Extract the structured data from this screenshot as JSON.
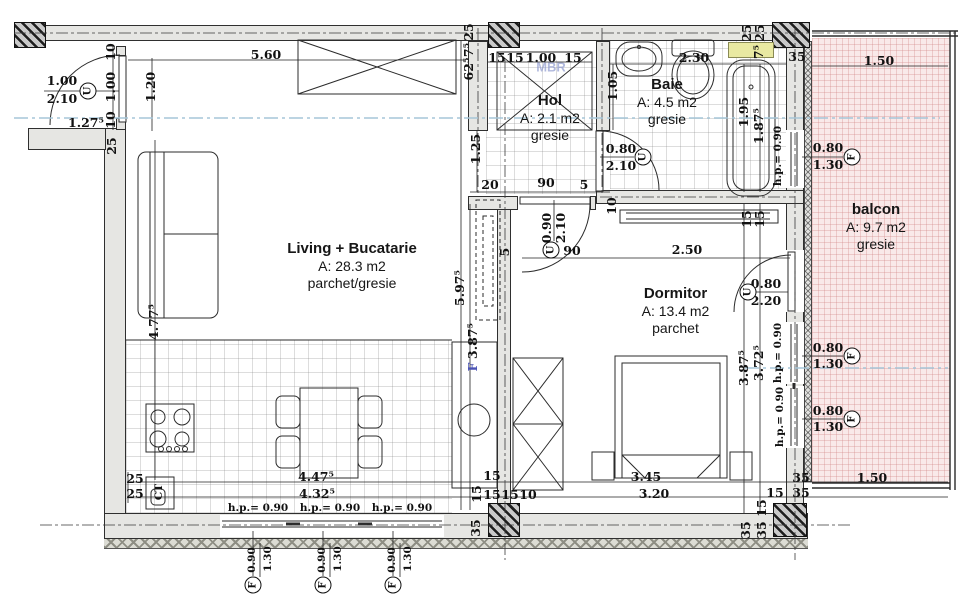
{
  "plan_title": "apartment-floor-plan",
  "colors": {
    "wall": "#e6e6e3",
    "balcony_fill": "#f9e9e9",
    "accent_yellow": "#e9e9a2",
    "section_line": "#a5c6d8",
    "watermark_blue": "#8894cc",
    "dim_blue": "#4a52b4",
    "line": "#2b2b2b"
  },
  "rooms": [
    {
      "id": "living",
      "name": "Living + Bucatarie",
      "area": "A: 28.3 m2",
      "floor": "parchet/gresie",
      "x": 252,
      "y": 240,
      "w": 200
    },
    {
      "id": "hol",
      "name": "Hol",
      "area": "A: 2.1 m2",
      "floor": "gresie",
      "x": 500,
      "y": 92,
      "w": 100
    },
    {
      "id": "baie",
      "name": "Baie",
      "area": "A: 4.5 m2",
      "floor": "gresie",
      "x": 617,
      "y": 76,
      "w": 100
    },
    {
      "id": "dormitor",
      "name": "Dormitor",
      "area": "A: 13.4 m2",
      "floor": "parchet",
      "x": 613,
      "y": 285,
      "w": 125
    },
    {
      "id": "balcon",
      "name": "balcon",
      "area": "A: 9.7 m2",
      "floor": "gresie",
      "x": 826,
      "y": 201,
      "w": 100
    }
  ],
  "dims": [
    {
      "t": "5.60",
      "x": 266,
      "y": 55
    },
    {
      "t": "15",
      "x": 497,
      "y": 58
    },
    {
      "t": "15",
      "x": 515,
      "y": 58
    },
    {
      "t": "1.00",
      "x": 541,
      "y": 58
    },
    {
      "t": "15",
      "x": 573,
      "y": 58
    },
    {
      "t": "2.30",
      "x": 694,
      "y": 58
    },
    {
      "t": "1.50",
      "x": 879,
      "y": 61
    },
    {
      "t": "25",
      "x": 469,
      "y": 32,
      "r": 1
    },
    {
      "t": "7⁵",
      "x": 469,
      "y": 50,
      "r": 1
    },
    {
      "t": "62⁵",
      "x": 469,
      "y": 69,
      "r": 1
    },
    {
      "t": "25",
      "x": 747,
      "y": 33,
      "r": 1
    },
    {
      "t": "25",
      "x": 760,
      "y": 33,
      "r": 1
    },
    {
      "t": "7⁵",
      "x": 759,
      "y": 52,
      "r": 1
    },
    {
      "t": "35",
      "x": 797,
      "y": 57
    },
    {
      "t": "MBR",
      "x": 551,
      "y": 67,
      "c": "wm"
    },
    {
      "t": "10",
      "x": 111,
      "y": 52,
      "r": 1
    },
    {
      "t": "1.00",
      "x": 111,
      "y": 87,
      "r": 1
    },
    {
      "t": "10",
      "x": 111,
      "y": 120,
      "r": 1
    },
    {
      "t": "25",
      "x": 112,
      "y": 146,
      "r": 1
    },
    {
      "t": "1.20",
      "x": 151,
      "y": 87,
      "r": 1
    },
    {
      "t": "1.00",
      "x": 62,
      "y": 81
    },
    {
      "t": "2.10",
      "x": 62,
      "y": 99
    },
    {
      "t": "1.27⁵",
      "x": 86,
      "y": 123
    },
    {
      "t": "4.77⁵",
      "x": 154,
      "y": 322,
      "r": 1
    },
    {
      "t": "1.25",
      "x": 476,
      "y": 149,
      "r": 1
    },
    {
      "t": "1.05",
      "x": 613,
      "y": 86,
      "r": 1
    },
    {
      "t": "20",
      "x": 490,
      "y": 185
    },
    {
      "t": "90",
      "x": 546,
      "y": 183
    },
    {
      "t": "5",
      "x": 584,
      "y": 185
    },
    {
      "t": "10",
      "x": 612,
      "y": 206,
      "r": 1
    },
    {
      "t": "0.80",
      "x": 621,
      "y": 149
    },
    {
      "t": "2.10",
      "x": 621,
      "y": 166
    },
    {
      "t": "0.90",
      "x": 547,
      "y": 228,
      "r": 1
    },
    {
      "t": "2.10",
      "x": 561,
      "y": 228,
      "r": 1
    },
    {
      "t": "90",
      "x": 572,
      "y": 251
    },
    {
      "t": "5",
      "x": 505,
      "y": 252,
      "r": 1
    },
    {
      "t": "5.97⁵",
      "x": 460,
      "y": 288,
      "r": 1
    },
    {
      "t": "3.87⁵",
      "x": 473,
      "y": 341,
      "r": 1
    },
    {
      "t": "F",
      "x": 473,
      "y": 367,
      "r": 1,
      "c": "bf"
    },
    {
      "t": "1.95",
      "x": 744,
      "y": 112,
      "r": 1
    },
    {
      "t": "1.87⁵",
      "x": 759,
      "y": 126,
      "r": 1
    },
    {
      "t": "h.p.= 0.90",
      "x": 778,
      "y": 156,
      "r": 1,
      "s": 1
    },
    {
      "t": "0.80",
      "x": 828,
      "y": 148
    },
    {
      "t": "1.30",
      "x": 828,
      "y": 165
    },
    {
      "t": "2.50",
      "x": 687,
      "y": 250
    },
    {
      "t": "15",
      "x": 747,
      "y": 219,
      "r": 1
    },
    {
      "t": "15",
      "x": 760,
      "y": 219,
      "r": 1
    },
    {
      "t": "0.80",
      "x": 766,
      "y": 284
    },
    {
      "t": "2.20",
      "x": 766,
      "y": 301
    },
    {
      "t": "3.87⁵",
      "x": 744,
      "y": 368,
      "r": 1
    },
    {
      "t": "3.72⁵",
      "x": 759,
      "y": 363,
      "r": 1
    },
    {
      "t": "h.p.= 0.90",
      "x": 778,
      "y": 353,
      "r": 1,
      "s": 1
    },
    {
      "t": "h.p.= 0.90",
      "x": 780,
      "y": 417,
      "r": 1,
      "s": 1
    },
    {
      "t": "0.80",
      "x": 828,
      "y": 348
    },
    {
      "t": "1.30",
      "x": 828,
      "y": 364
    },
    {
      "t": "0.80",
      "x": 828,
      "y": 411
    },
    {
      "t": "1.30",
      "x": 828,
      "y": 427
    },
    {
      "t": "25",
      "x": 135,
      "y": 479
    },
    {
      "t": "25",
      "x": 135,
      "y": 494
    },
    {
      "t": "CT",
      "x": 159,
      "y": 492,
      "r": 1,
      "s": 1
    },
    {
      "t": "4.47⁵",
      "x": 316,
      "y": 477
    },
    {
      "t": "4.32⁵",
      "x": 317,
      "y": 494
    },
    {
      "t": "h.p.= 0.90",
      "x": 258,
      "y": 508,
      "s": 1
    },
    {
      "t": "h.p.= 0.90",
      "x": 330,
      "y": 508,
      "s": 1
    },
    {
      "t": "h.p.= 0.90",
      "x": 402,
      "y": 508,
      "s": 1
    },
    {
      "t": "0.90",
      "x": 252,
      "y": 560,
      "r": 1,
      "s": 1
    },
    {
      "t": "1.30",
      "x": 268,
      "y": 559,
      "r": 1,
      "s": 1
    },
    {
      "t": "0.90",
      "x": 322,
      "y": 560,
      "r": 1,
      "s": 1
    },
    {
      "t": "1.30",
      "x": 338,
      "y": 559,
      "r": 1,
      "s": 1
    },
    {
      "t": "0.90",
      "x": 392,
      "y": 560,
      "r": 1,
      "s": 1
    },
    {
      "t": "1.30",
      "x": 408,
      "y": 559,
      "r": 1,
      "s": 1
    },
    {
      "t": "15",
      "x": 492,
      "y": 476
    },
    {
      "t": "15",
      "x": 477,
      "y": 494,
      "r": 1
    },
    {
      "t": "15",
      "x": 492,
      "y": 495
    },
    {
      "t": "15",
      "x": 510,
      "y": 495
    },
    {
      "t": "10",
      "x": 528,
      "y": 495
    },
    {
      "t": "35",
      "x": 476,
      "y": 528,
      "r": 1
    },
    {
      "t": "3.45",
      "x": 646,
      "y": 477
    },
    {
      "t": "3.20",
      "x": 654,
      "y": 494
    },
    {
      "t": "35",
      "x": 801,
      "y": 478
    },
    {
      "t": "1.50",
      "x": 872,
      "y": 478
    },
    {
      "t": "15",
      "x": 775,
      "y": 493
    },
    {
      "t": "35",
      "x": 801,
      "y": 493
    },
    {
      "t": "15",
      "x": 762,
      "y": 508,
      "r": 1
    },
    {
      "t": "35",
      "x": 746,
      "y": 530,
      "r": 1
    },
    {
      "t": "35",
      "x": 762,
      "y": 530,
      "r": 1
    }
  ],
  "symbols": [
    {
      "l": "U",
      "x": 88,
      "y": 91
    },
    {
      "l": "U",
      "x": 643,
      "y": 157
    },
    {
      "l": "U",
      "x": 551,
      "y": 250
    },
    {
      "l": "U",
      "x": 748,
      "y": 292
    },
    {
      "l": "F",
      "x": 852,
      "y": 157
    },
    {
      "l": "F",
      "x": 852,
      "y": 356
    },
    {
      "l": "F",
      "x": 852,
      "y": 419
    },
    {
      "l": "F",
      "x": 253,
      "y": 585
    },
    {
      "l": "F",
      "x": 323,
      "y": 585
    },
    {
      "l": "F",
      "x": 393,
      "y": 585
    }
  ]
}
